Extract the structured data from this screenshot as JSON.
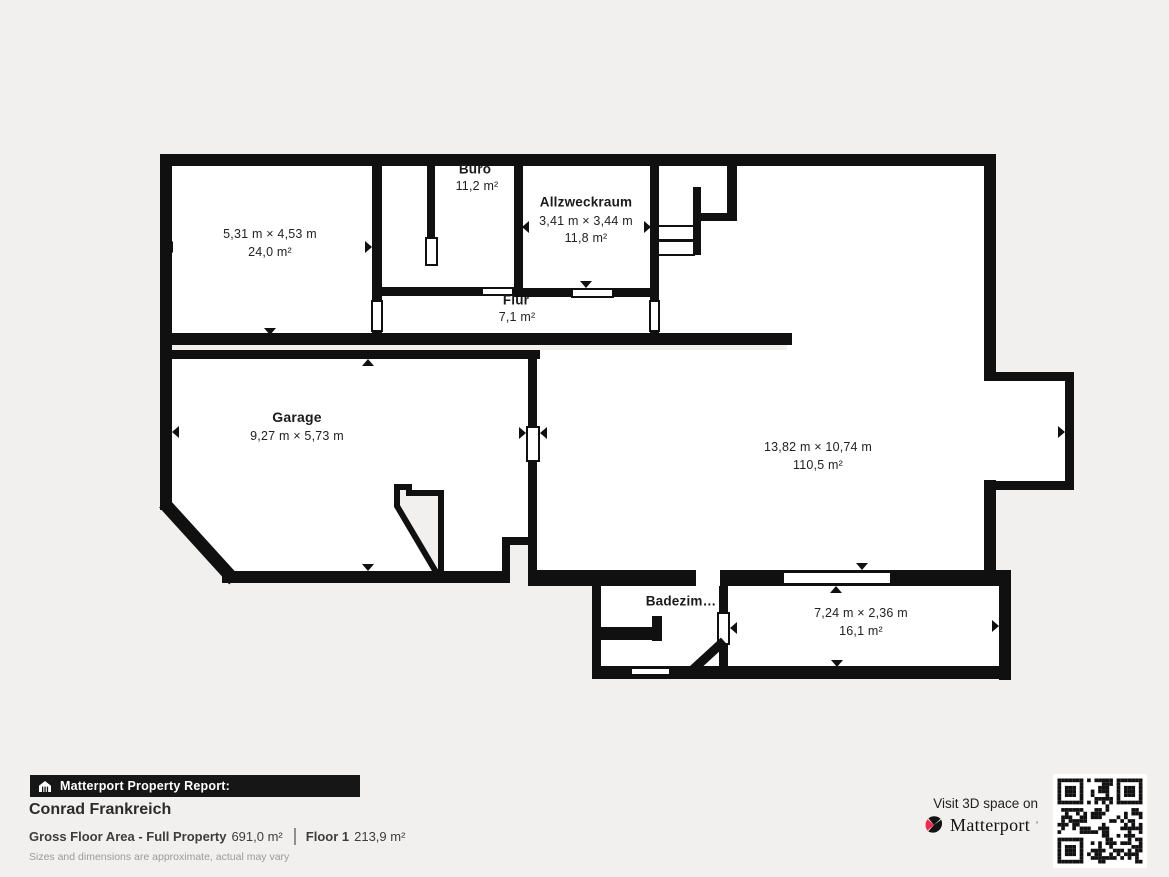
{
  "floorplan": {
    "rooms": [
      {
        "dims": "5,31 m × 4,53 m",
        "area": "24,0 m²"
      },
      {
        "label": "Büro",
        "area": "11,2 m²"
      },
      {
        "label": "Allzweckraum",
        "dims": "3,41 m × 3,44 m",
        "area": "11,8 m²"
      },
      {
        "label": "Flur",
        "area": "7,1 m²"
      },
      {
        "label": "Garage",
        "dims": "9,27 m × 5,73 m"
      },
      {
        "dims": "13,82 m × 10,74 m",
        "area": "110,5 m²"
      },
      {
        "label": "Badezim…"
      },
      {
        "dims": "7,24 m × 2,36 m",
        "area": "16,1 m²"
      }
    ]
  },
  "footer": {
    "report_label": "Matterport Property Report:",
    "property_name": "Conrad Frankreich",
    "gfa_label": "Gross Floor Area - Full Property",
    "gfa_value": "691,0 m²",
    "floor_label": "Floor 1",
    "floor_value": "213,9 m²",
    "disclaimer": "Sizes and dimensions are approximate, actual may vary"
  },
  "cta": {
    "visit_text": "Visit 3D space on",
    "brand": "Matterport",
    "brand_mark": "’"
  },
  "colors": {
    "background": "#f1f0ee",
    "wall": "#101010",
    "floor": "#ffffff",
    "brand_red": "#ee2b4e"
  }
}
